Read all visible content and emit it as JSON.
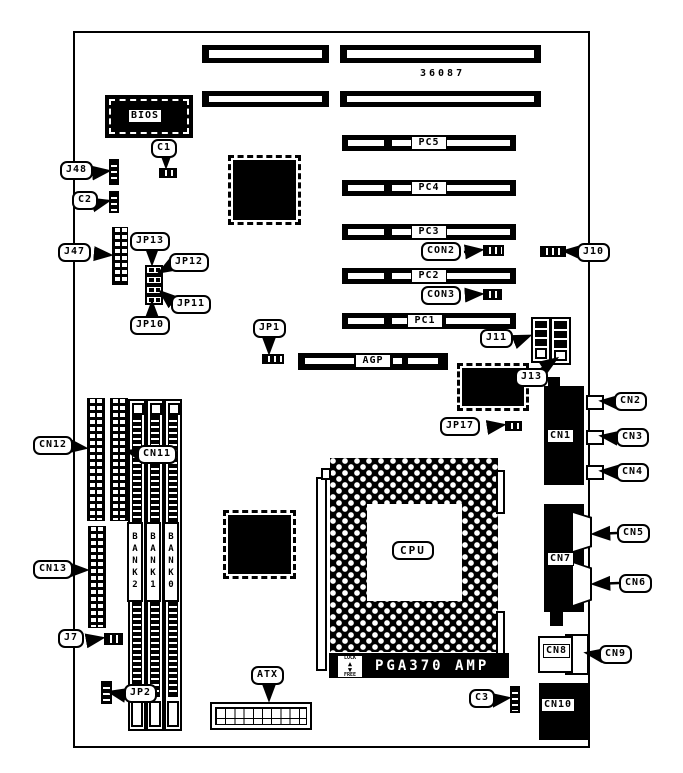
{
  "board": {
    "part_number": "36087",
    "cpu_label": "CPU",
    "socket_label": "PGA370 AMP",
    "lock_label": "LOCK",
    "free_label": "FREE",
    "lock_up_icon": "▲",
    "lock_down_icon": "▼"
  },
  "chips": {
    "bios": "BIOS"
  },
  "slots": {
    "pc5": "PC5",
    "pc4": "PC4",
    "pc3": "PC3",
    "pc2": "PC2",
    "pc1": "PC1",
    "agp": "AGP"
  },
  "memory": {
    "bank2": "BANK2",
    "bank1": "BANK1",
    "bank0": "BANK0"
  },
  "connector_tags": {
    "cn1": "CN1",
    "cn7": "CN7",
    "cn8": "CN8",
    "cn10": "CN10"
  },
  "callouts": {
    "j48": "J48",
    "c1": "C1",
    "c2": "C2",
    "j47": "J47",
    "jp13": "JP13",
    "jp12": "JP12",
    "jp11": "JP11",
    "jp10": "JP10",
    "jp1": "JP1",
    "con2": "CON2",
    "con3": "CON3",
    "j10": "J10",
    "j11": "J11",
    "j13": "J13",
    "jp17": "JP17",
    "cn2": "CN2",
    "cn3": "CN3",
    "cn4": "CN4",
    "cn5": "CN5",
    "cn6": "CN6",
    "cn9": "CN9",
    "cn11": "CN11",
    "cn12": "CN12",
    "cn13": "CN13",
    "j7": "J7",
    "jp2": "JP2",
    "atx": "ATX",
    "c3": "C3"
  }
}
